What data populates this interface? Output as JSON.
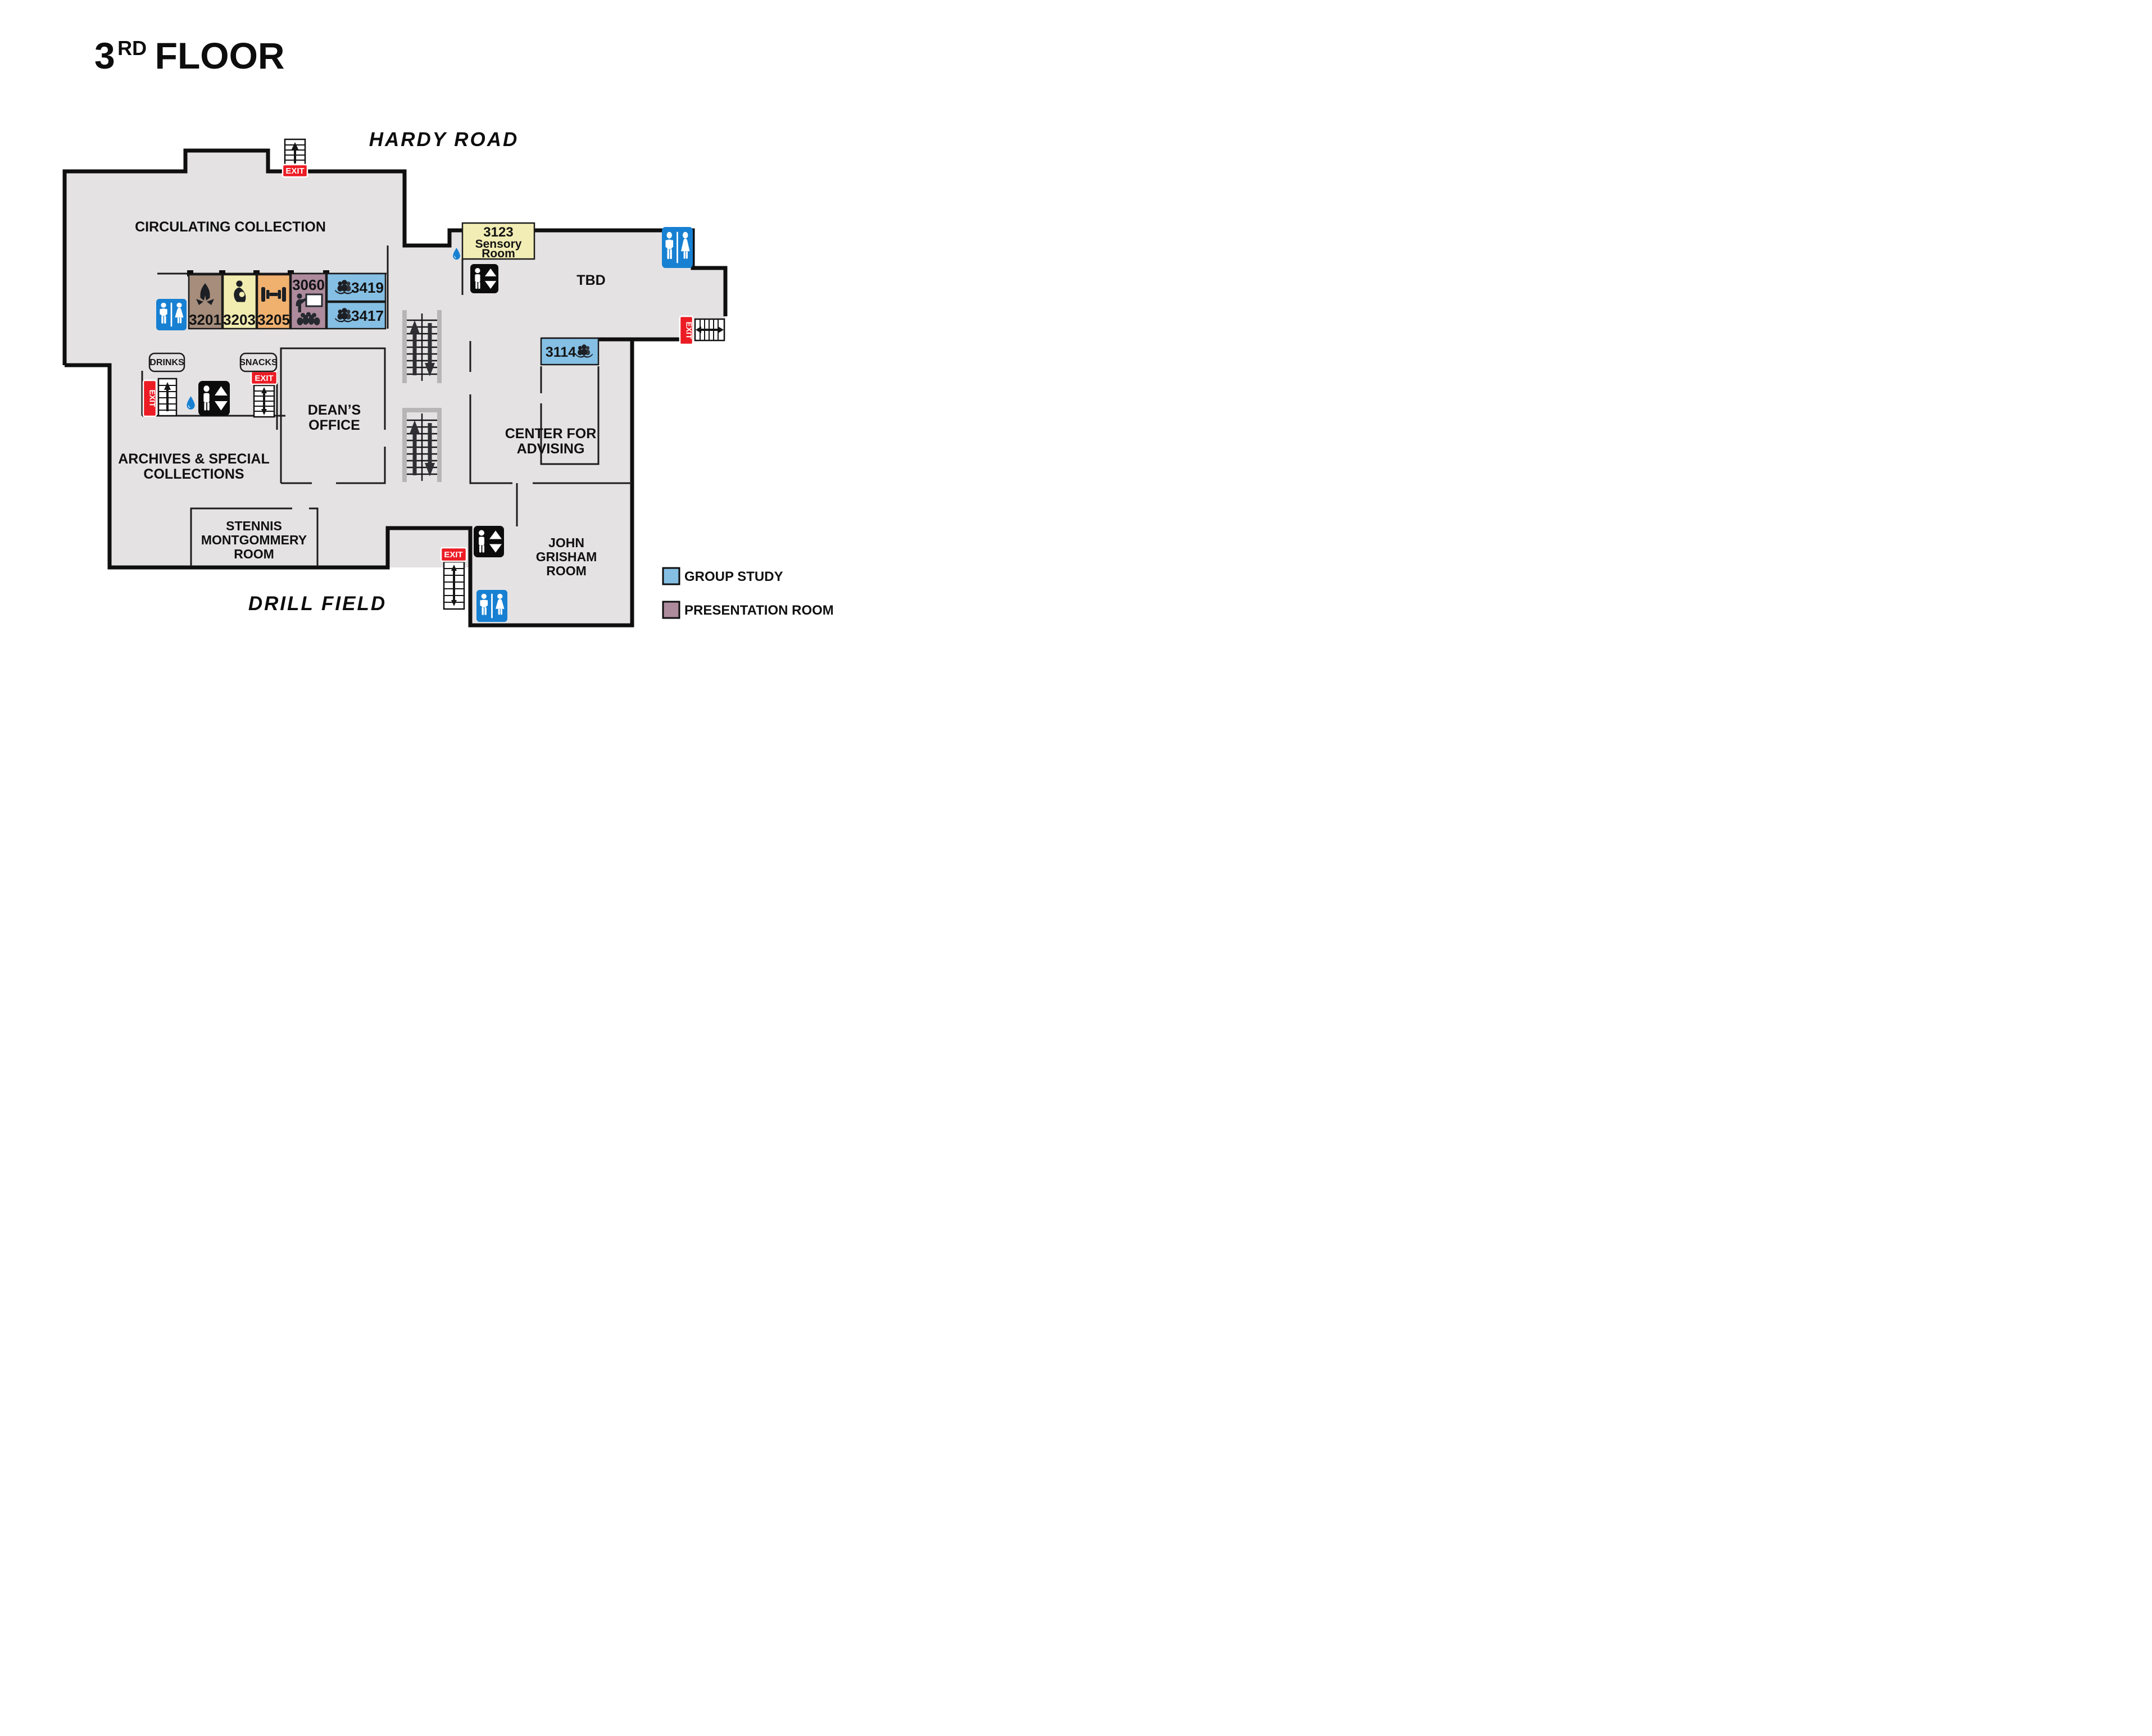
{
  "title": {
    "number": "3",
    "ordinal": "RD",
    "word": "FLOOR"
  },
  "streets": {
    "top": "HARDY ROAD",
    "bottom": "DRILL FIELD"
  },
  "areas": {
    "circulating": {
      "label": "CIRCULATING COLLECTION"
    },
    "archives": {
      "lines": [
        "ARCHIVES & SPECIAL",
        "COLLECTIONS"
      ]
    },
    "deans": {
      "lines": [
        "DEAN’S",
        "OFFICE"
      ]
    },
    "stennis": {
      "lines": [
        "STENNIS",
        "MONTGOMMERY",
        "ROOM"
      ]
    },
    "advising": {
      "lines": [
        "CENTER FOR",
        "ADVISING"
      ]
    },
    "grisham": {
      "lines": [
        "JOHN",
        "GRISHAM",
        "ROOM"
      ]
    },
    "tbd": {
      "label": "TBD"
    }
  },
  "rooms": [
    {
      "id": "3201",
      "type": "prayer-room",
      "color": "#a68d7c"
    },
    {
      "id": "3203",
      "type": "lactation-room",
      "color": "#f1ecb0"
    },
    {
      "id": "3205",
      "type": "fitness-room",
      "color": "#f0b06e"
    },
    {
      "id": "3060",
      "type": "presentation-room",
      "color": "#ad8b9c"
    },
    {
      "id": "3419",
      "type": "group-study",
      "color": "#85bfe4"
    },
    {
      "id": "3417",
      "type": "group-study",
      "color": "#85bfe4"
    },
    {
      "id": "3123",
      "name_lines": [
        "Sensory",
        "Room"
      ],
      "type": "sensory-room",
      "color": "#f2edb4"
    },
    {
      "id": "3114",
      "type": "group-study",
      "color": "#85bfe4"
    }
  ],
  "legend": {
    "items": [
      {
        "label": "GROUP STUDY",
        "color": "#85bfe4"
      },
      {
        "label": "PRESENTATION ROOM",
        "color": "#ad8b9c"
      }
    ]
  },
  "labels": {
    "exit": "EXIT",
    "drinks": "DRINKS",
    "snacks": "SNACKS"
  },
  "colors": {
    "floor": "#e4e2e3",
    "wall": "#0f0f0f",
    "restroom_blue": "#1780d2",
    "exit_red": "#ec1c24",
    "icon_dark": "#1c1f24",
    "stair_frame": "#b7b5b6",
    "water_blue": "#1780d2"
  },
  "icons": {
    "restroom": "man and woman restroom sign",
    "elevator": "person with up-down triangles",
    "stairs": "staircase with direction arrows",
    "water": "water fountain droplet",
    "prayer": "praying hands",
    "lactation": "nursing mother with baby",
    "fitness": "dumbbell",
    "presentation": "presenter at whiteboard with audience",
    "group_study": "three readers over open book"
  }
}
